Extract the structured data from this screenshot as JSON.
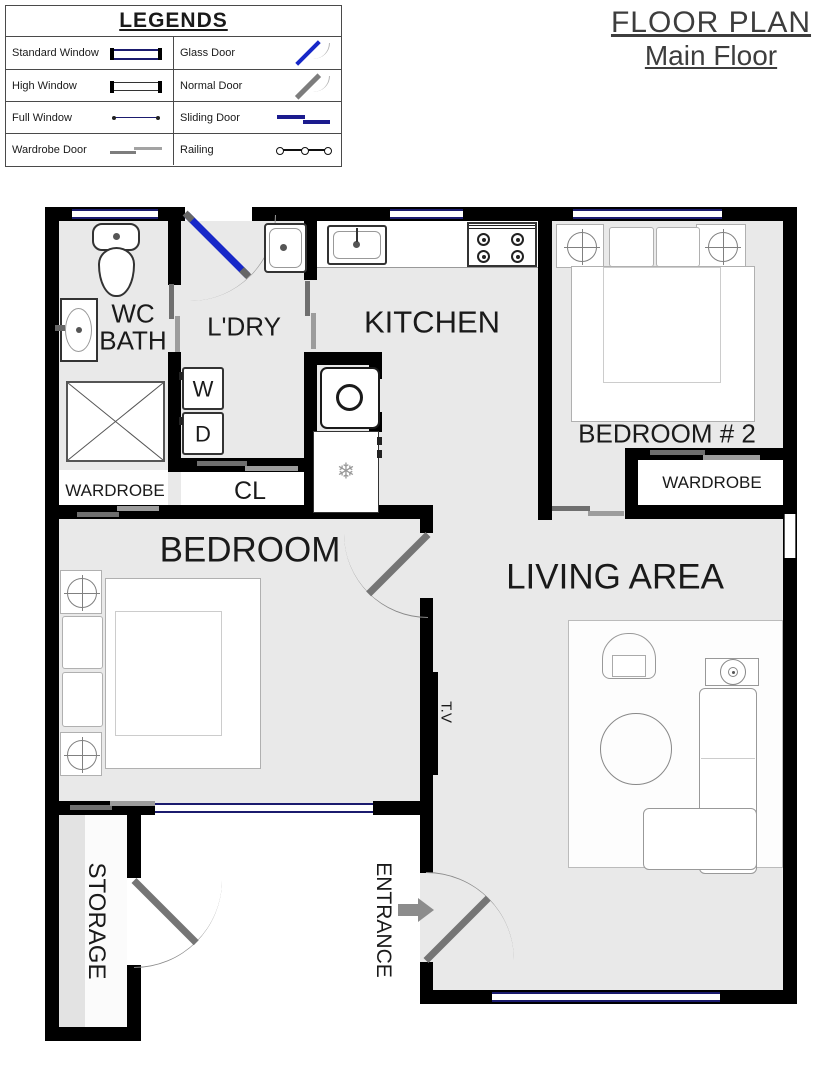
{
  "title": {
    "line1": "FLOOR PLAN",
    "line2": "Main Floor"
  },
  "legend": {
    "title": "LEGENDS",
    "left_items": [
      {
        "label": "Standard Window",
        "icon": "standard-window-icon"
      },
      {
        "label": "High Window",
        "icon": "high-window-icon"
      },
      {
        "label": "Full Window",
        "icon": "full-window-icon"
      },
      {
        "label": "Wardrobe Door",
        "icon": "wardrobe-door-icon"
      }
    ],
    "right_items": [
      {
        "label": "Glass Door",
        "icon": "glass-door-icon"
      },
      {
        "label": "Normal Door",
        "icon": "normal-door-icon"
      },
      {
        "label": "Sliding Door",
        "icon": "sliding-door-icon"
      },
      {
        "label": "Railing",
        "icon": "railing-icon"
      }
    ]
  },
  "rooms": {
    "wc_line1": "WC",
    "wc_line2": "BATH",
    "laundry": "L'DRY",
    "kitchen": "KITCHEN",
    "bedroom2": "BEDROOM # 2",
    "wardrobe_main": "WARDROBE",
    "closet": "CL",
    "wardrobe_bedroom2": "WARDROBE",
    "bedroom": "BEDROOM",
    "living": "LIVING AREA",
    "storage": "STORAGE",
    "entrance": "ENTRANCE",
    "tv": "T.V"
  },
  "appliances": {
    "washer": "W",
    "dryer": "D"
  },
  "icons": {
    "snowflake": "❄"
  },
  "colors": {
    "wall": "#000000",
    "floor": "#e9e9e9",
    "window_line": "#1b1b6e",
    "glass_door": "#1728c8",
    "door": "#757575",
    "text": "#1a1a1a"
  }
}
